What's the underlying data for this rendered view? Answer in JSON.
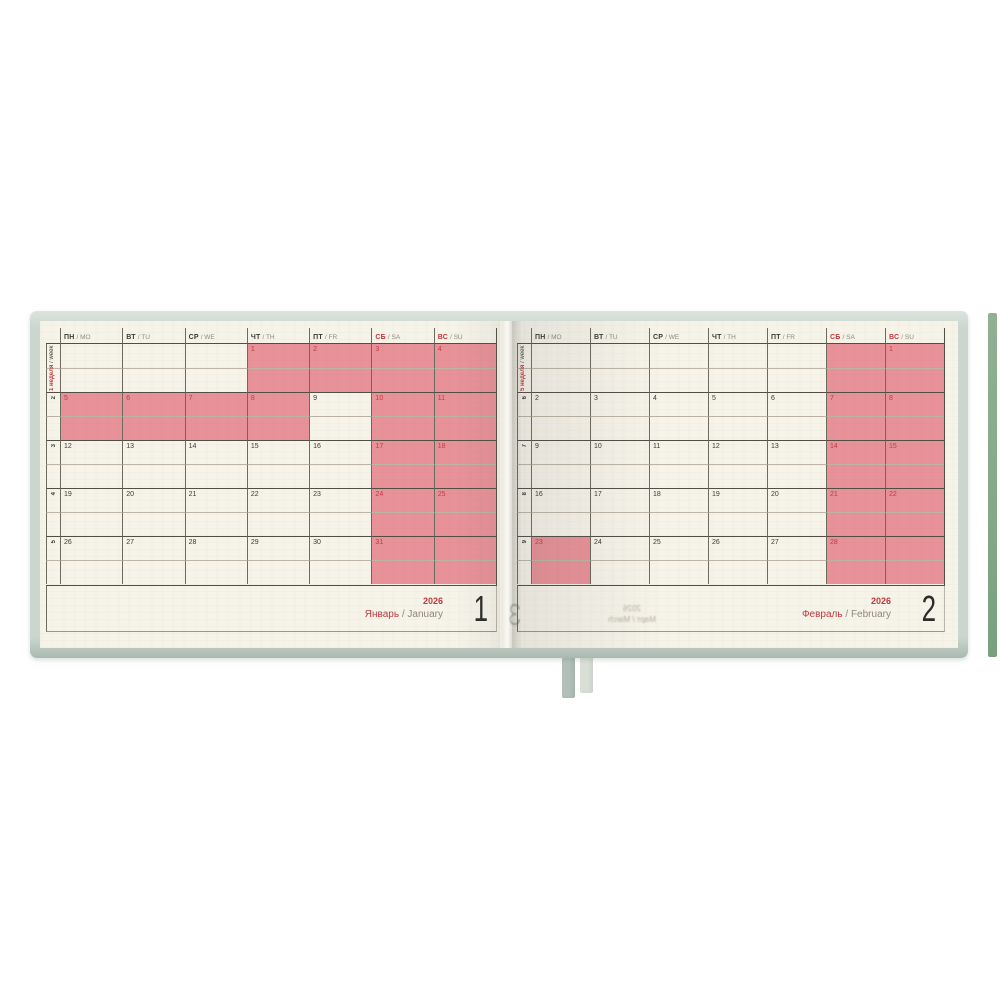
{
  "colors": {
    "cover": "#cbd6cf",
    "page": "#f6f3e9",
    "holiday_fill": "#e89198",
    "holiday_number": "#c23a42",
    "accent_red": "#c0393f",
    "grid_dark": "#514e46",
    "grid_soft": "#6e6a60",
    "grid_light": "#bcb5a6",
    "day_number": "#3b3a33",
    "muted_text": "#8d897c",
    "footer_rule": "#c5837c",
    "edge_strip": "#87a98a",
    "ribbon_green": "#b1c1b9",
    "ribbon_light": "#d9dfd7"
  },
  "labels": {
    "sep": "/"
  },
  "day_headers": [
    {
      "ru": "ПН",
      "en": "MO",
      "weekend": false
    },
    {
      "ru": "ВТ",
      "en": "TU",
      "weekend": false
    },
    {
      "ru": "СР",
      "en": "WE",
      "weekend": false
    },
    {
      "ru": "ЧТ",
      "en": "TH",
      "weekend": false
    },
    {
      "ru": "ПТ",
      "en": "FR",
      "weekend": false
    },
    {
      "ru": "СБ",
      "en": "SA",
      "weekend": true
    },
    {
      "ru": "ВС",
      "en": "SU",
      "weekend": true
    }
  ],
  "pages": [
    {
      "year": "2026",
      "month_ru": "Январь",
      "month_en": "January",
      "month_number": "1",
      "first_week_label": {
        "ru": "1 неделя",
        "en": "week"
      },
      "week_numbers": [
        "2",
        "3",
        "4",
        "5"
      ],
      "weeks": [
        [
          {
            "n": "",
            "h": false
          },
          {
            "n": "",
            "h": false
          },
          {
            "n": "",
            "h": false
          },
          {
            "n": "1",
            "h": true
          },
          {
            "n": "2",
            "h": true
          },
          {
            "n": "3",
            "h": true
          },
          {
            "n": "4",
            "h": true
          }
        ],
        [
          {
            "n": "5",
            "h": true
          },
          {
            "n": "6",
            "h": true
          },
          {
            "n": "7",
            "h": true
          },
          {
            "n": "8",
            "h": true
          },
          {
            "n": "9",
            "h": false
          },
          {
            "n": "10",
            "h": true
          },
          {
            "n": "11",
            "h": true
          }
        ],
        [
          {
            "n": "12",
            "h": false
          },
          {
            "n": "13",
            "h": false
          },
          {
            "n": "14",
            "h": false
          },
          {
            "n": "15",
            "h": false
          },
          {
            "n": "16",
            "h": false
          },
          {
            "n": "17",
            "h": true
          },
          {
            "n": "18",
            "h": true
          }
        ],
        [
          {
            "n": "19",
            "h": false
          },
          {
            "n": "20",
            "h": false
          },
          {
            "n": "21",
            "h": false
          },
          {
            "n": "22",
            "h": false
          },
          {
            "n": "23",
            "h": false
          },
          {
            "n": "24",
            "h": true
          },
          {
            "n": "25",
            "h": true
          }
        ],
        [
          {
            "n": "26",
            "h": false
          },
          {
            "n": "27",
            "h": false
          },
          {
            "n": "28",
            "h": false
          },
          {
            "n": "29",
            "h": false
          },
          {
            "n": "30",
            "h": false
          },
          {
            "n": "31",
            "h": true
          },
          {
            "n": "",
            "h": true
          }
        ]
      ]
    },
    {
      "year": "2026",
      "month_ru": "Февраль",
      "month_en": "February",
      "month_number": "2",
      "first_week_label": {
        "ru": "5 неделя",
        "en": "week"
      },
      "week_numbers": [
        "6",
        "7",
        "8",
        "9"
      ],
      "weeks": [
        [
          {
            "n": "",
            "h": false
          },
          {
            "n": "",
            "h": false
          },
          {
            "n": "",
            "h": false
          },
          {
            "n": "",
            "h": false
          },
          {
            "n": "",
            "h": false
          },
          {
            "n": "",
            "h": true
          },
          {
            "n": "1",
            "h": true
          }
        ],
        [
          {
            "n": "2",
            "h": false
          },
          {
            "n": "3",
            "h": false
          },
          {
            "n": "4",
            "h": false
          },
          {
            "n": "5",
            "h": false
          },
          {
            "n": "6",
            "h": false
          },
          {
            "n": "7",
            "h": true
          },
          {
            "n": "8",
            "h": true
          }
        ],
        [
          {
            "n": "9",
            "h": false
          },
          {
            "n": "10",
            "h": false
          },
          {
            "n": "11",
            "h": false
          },
          {
            "n": "12",
            "h": false
          },
          {
            "n": "13",
            "h": false
          },
          {
            "n": "14",
            "h": true
          },
          {
            "n": "15",
            "h": true
          }
        ],
        [
          {
            "n": "16",
            "h": false
          },
          {
            "n": "17",
            "h": false
          },
          {
            "n": "18",
            "h": false
          },
          {
            "n": "19",
            "h": false
          },
          {
            "n": "20",
            "h": false
          },
          {
            "n": "21",
            "h": true
          },
          {
            "n": "22",
            "h": true
          }
        ],
        [
          {
            "n": "23",
            "h": true
          },
          {
            "n": "24",
            "h": false
          },
          {
            "n": "25",
            "h": false
          },
          {
            "n": "26",
            "h": false
          },
          {
            "n": "27",
            "h": false
          },
          {
            "n": "28",
            "h": true
          },
          {
            "n": "",
            "h": true
          }
        ]
      ],
      "show_through": {
        "digit": "3",
        "year": "2026",
        "month": "Март / March"
      }
    }
  ]
}
